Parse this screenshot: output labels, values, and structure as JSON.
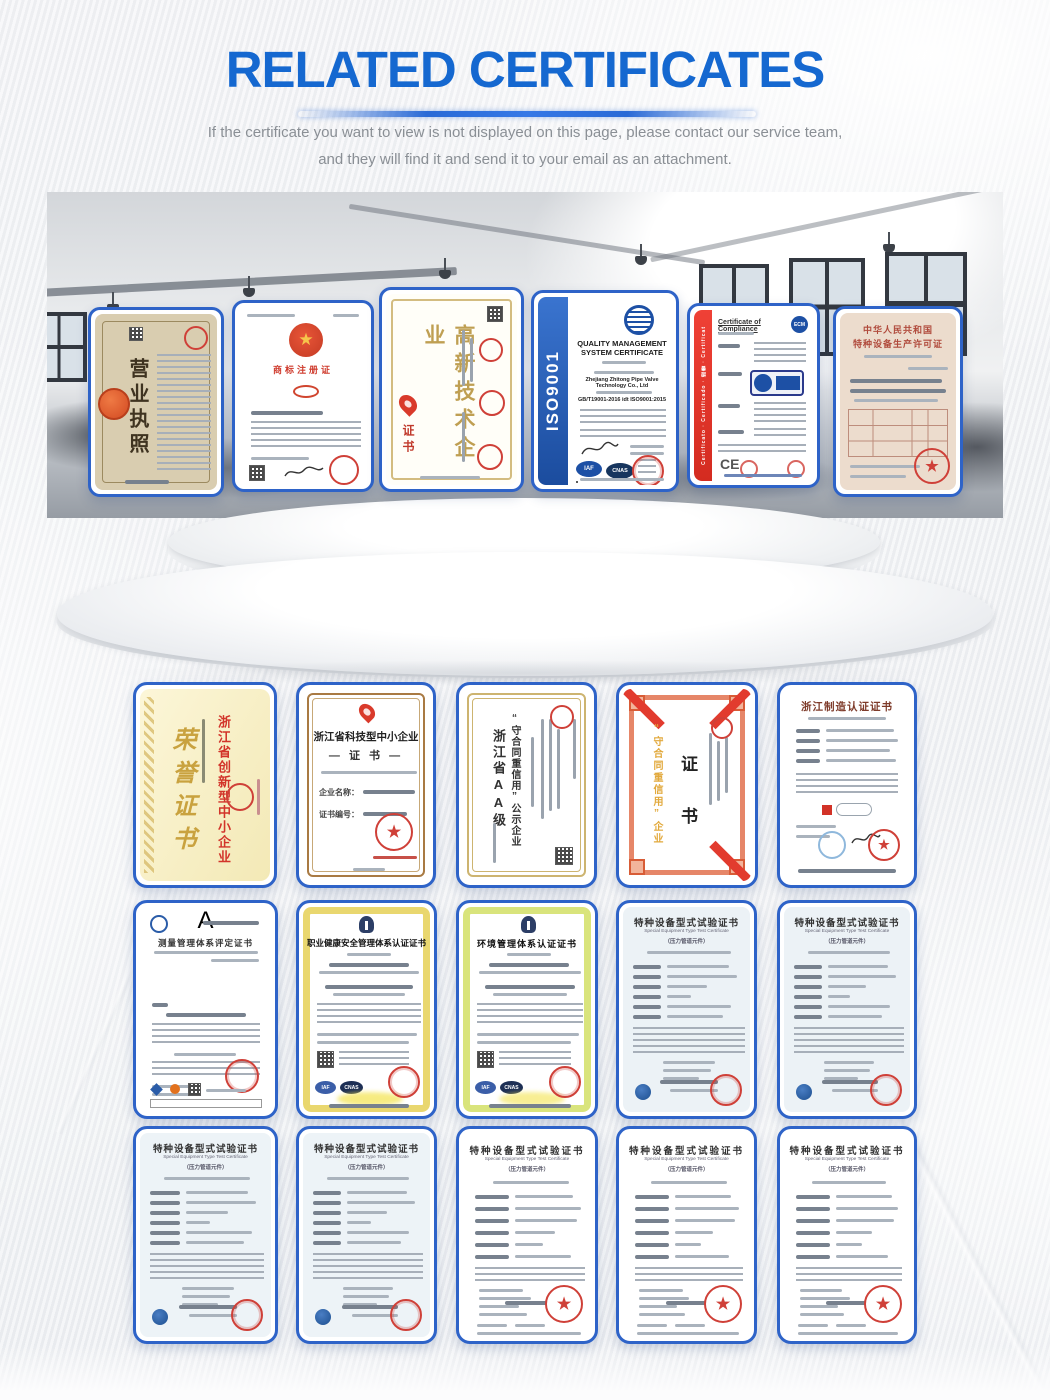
{
  "header": {
    "title": "RELATED CERTIFICATES",
    "subtitle_line1": "If the certificate you want to view is not displayed on this page, please contact our service team,",
    "subtitle_line2": "and they will find it and send it to your email as an attachment."
  },
  "colors": {
    "accent_blue": "#1568d0",
    "card_border": "#2e63c8"
  },
  "icons": {
    "star": "★"
  },
  "hero": {
    "certs": [
      {
        "name": "business-license",
        "title": "营业执照"
      },
      {
        "name": "trademark-registration",
        "title": "商标注册证"
      },
      {
        "name": "high-tech-enterprise",
        "title": "高新技术企业",
        "seal_label": "证书"
      },
      {
        "name": "iso9001",
        "band": "ISO9001",
        "title": "QUALITY MANAGEMENT SYSTEM CERTIFICATE",
        "company": "Zhejiang Zhitong Pipe Valve Technology Co., Ltd",
        "standard": "GB/T19001-2016 idt ISO9001:2015",
        "logo1": "IAF",
        "logo2": "CNAS"
      },
      {
        "name": "certificate-of-compliance",
        "title": "Certificate of Compliance",
        "band": "Certificato · Certificado · 證書 · Certificat",
        "logo": "ECM",
        "ce": "CE"
      },
      {
        "name": "special-equipment-production-license",
        "title_line1": "中华人民共和国",
        "title_line2": "特种设备生产许可证"
      }
    ]
  },
  "grid": {
    "row1": [
      {
        "name": "honor-certificate",
        "title": "荣誉证书",
        "highlight": "浙江省创新型中小企业"
      },
      {
        "name": "tech-sme-certificate",
        "title": "浙江省科技型中小企业",
        "subtitle": "— 证 书 —",
        "field1": "企业名称：",
        "field2": "证书编号："
      },
      {
        "name": "aa-contract-credit",
        "title_col1": "浙江省AA级",
        "title_col2": "“守合同重信用”公示企业"
      },
      {
        "name": "contract-credit-certificate",
        "gold": "“守合同重信用”企业",
        "subtitle": "证 书"
      },
      {
        "name": "zhejiang-made",
        "title": "浙江制造认证证书"
      }
    ],
    "row2": [
      {
        "name": "measurement-system",
        "title": "测量管理体系评定证书",
        "grade": "A"
      },
      {
        "name": "ohs-management",
        "title": "职业健康安全管理体系认证证书",
        "logo1": "IAF",
        "logo2": "CNAS"
      },
      {
        "name": "environment-management",
        "title": "环境管理体系认证证书",
        "logo1": "IAF",
        "logo2": "CNAS"
      },
      {
        "name": "type-test-1",
        "title": "特种设备型式试验证书",
        "subtitle_en": "Special Equipment Type Test Certificate",
        "scope": "（压力管道元件）"
      },
      {
        "name": "type-test-2",
        "title": "特种设备型式试验证书",
        "subtitle_en": "Special Equipment Type Test Certificate",
        "scope": "（压力管道元件）"
      }
    ],
    "row3": [
      {
        "name": "type-test-3",
        "title": "特种设备型式试验证书",
        "subtitle_en": "Special Equipment Type Test Certificate",
        "scope": "（压力管道元件）"
      },
      {
        "name": "type-test-4",
        "title": "特种设备型式试验证书",
        "subtitle_en": "Special Equipment Type Test Certificate",
        "scope": "（压力管道元件）"
      },
      {
        "name": "type-test-5",
        "title": "特种设备型式试验证书",
        "subtitle_en": "Special Equipment Type Test Certificate",
        "scope": "（压力管道元件）"
      },
      {
        "name": "type-test-6",
        "title": "特种设备型式试验证书",
        "subtitle_en": "Special Equipment Type Test Certificate",
        "scope": "（压力管道元件）"
      },
      {
        "name": "type-test-7",
        "title": "特种设备型式试验证书",
        "subtitle_en": "Special Equipment Type Test Certificate",
        "scope": "（压力管道元件）"
      }
    ]
  }
}
